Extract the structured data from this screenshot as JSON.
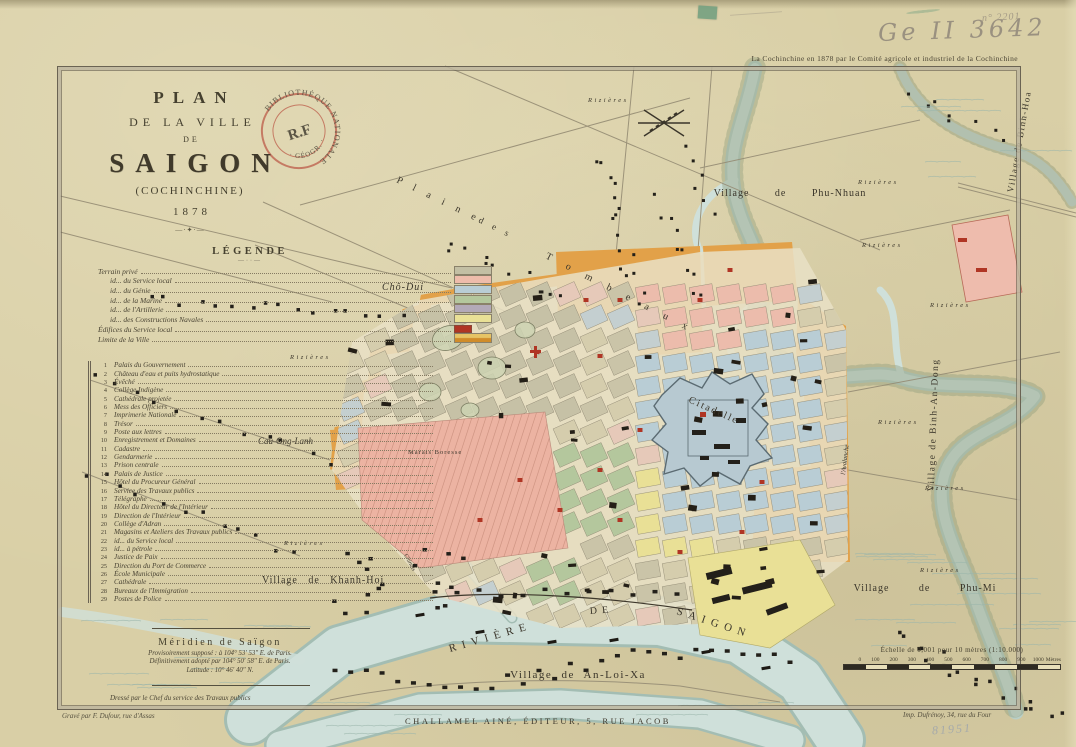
{
  "header": {
    "pencil_number": "n° 2201",
    "shelfmark": "Ge II 3642",
    "credit": "La Cochinchine en 1878 par le Comité agricole et industriel de la Cochinchine"
  },
  "title_block": {
    "plan": "PLAN",
    "de_la_ville": "DE LA VILLE",
    "de": "DE",
    "city": "SAIGON",
    "region": "(COCHINCHINE)",
    "year": "1878",
    "ornament": "—·✦·—"
  },
  "stamp": {
    "arc_top": "BIBLIOTHÈQUE NATIONALE",
    "center": "R.F",
    "arc_bottom": "· GÉOGR. ·"
  },
  "legend": {
    "title": "LÉGENDE",
    "ornament": "—··—",
    "items": [
      {
        "label": "Terrain privé",
        "color": "#c3bfa4"
      },
      {
        "label": "id... du Service local",
        "color": "#eebcab"
      },
      {
        "label": "id... du Génie",
        "color": "#b9cdd5"
      },
      {
        "label": "id... de la Marine",
        "color": "#b4c79d"
      },
      {
        "label": "id... de l'Artillerie",
        "color": "#b3a9b8"
      },
      {
        "label": "id... des Constructions Navales",
        "color": "#e9e096"
      },
      {
        "label": "Édifices du Service local",
        "color": "#b03524",
        "small": true
      },
      {
        "label": "Limite de la Ville",
        "color": "#e2a149",
        "band": true
      }
    ]
  },
  "index": {
    "items": [
      {
        "n": "1",
        "label": "Palais du Gouvernement"
      },
      {
        "n": "2",
        "label": "Château d'eau et puits hydrostatique"
      },
      {
        "n": "3",
        "label": "Évêché"
      },
      {
        "n": "4",
        "label": "Collège Indigène"
      },
      {
        "n": "5",
        "label": "Cathédrale projetée"
      },
      {
        "n": "6",
        "label": "Mess des Officiers"
      },
      {
        "n": "7",
        "label": "Imprimerie Nationale"
      },
      {
        "n": "8",
        "label": "Trésor"
      },
      {
        "n": "9",
        "label": "Poste aux lettres"
      },
      {
        "n": "10",
        "label": "Enregistrement et Domaines"
      },
      {
        "n": "11",
        "label": "Cadastre"
      },
      {
        "n": "12",
        "label": "Gendarmerie"
      },
      {
        "n": "13",
        "label": "Prison centrale"
      },
      {
        "n": "14",
        "label": "Palais de Justice"
      },
      {
        "n": "15",
        "label": "Hôtel du Procureur Général"
      },
      {
        "n": "16",
        "label": "Service des Travaux publics"
      },
      {
        "n": "17",
        "label": "Télégraphe"
      },
      {
        "n": "18",
        "label": "Hôtel du Directeur de l'Intérieur"
      },
      {
        "n": "19",
        "label": "Direction de l'Intérieur"
      },
      {
        "n": "20",
        "label": "Collège d'Adran"
      },
      {
        "n": "21",
        "label": "Magasins et Ateliers des Travaux publics"
      },
      {
        "n": "22",
        "label": "id... du Service local"
      },
      {
        "n": "23",
        "label": "id... à pétrole"
      },
      {
        "n": "24",
        "label": "Justice de Paix"
      },
      {
        "n": "25",
        "label": "Direction du Port de Commerce"
      },
      {
        "n": "26",
        "label": "École Municipale"
      },
      {
        "n": "27",
        "label": "Cathédrale"
      },
      {
        "n": "28",
        "label": "Bureaux de l'Immigration"
      },
      {
        "n": "29",
        "label": "Postes de Police"
      }
    ]
  },
  "meridian": {
    "title": "Méridien de Saïgon",
    "line1": "Provisoirement supposé : à 104° 53′ 53″ E. de Paris.",
    "line2": "Définitivement adopté par 104° 50′ 58″ E. de Paris.",
    "line3": "Latitude : 10° 46′ 40″ N."
  },
  "notes": {
    "drawn_by": "Dressé par le Chef du service des Travaux publics"
  },
  "imprint": {
    "engraver": "Gravé par F. Dufour, rue d'Assas",
    "publisher": "CHALLAMEL AINÉ, ÉDITEUR, 5, RUE JACOB",
    "printer": "Imp. Dufrénoy, 34, rue du Four",
    "inventory": "81951"
  },
  "scale": {
    "label": "Échelle de 0,001 pour 10 mètres (1:10.000)",
    "ticks": [
      "0",
      "100",
      "200",
      "300",
      "400",
      "500",
      "600",
      "700",
      "800",
      "900",
      "1000"
    ],
    "unit": "Mètres"
  },
  "map_labels": {
    "plaine": "P l a i n e",
    "des": "d e s",
    "tombeaux": "T o m b e a u x",
    "cho_dui": "Chô-Dui",
    "cau_ong_lanh": "Cau-Ong-Lanh",
    "marais_boresse": "Marais  Boresse",
    "citadelle": "Citadelle",
    "chinois": "Chinois",
    "avalanche": "l'Avalanche",
    "phu_nhuan": "Village de Phu-Nhuan",
    "binh_hoa": "Village de Binh-Hoa",
    "binh_an_dong": "Village de Binh-An-Dong",
    "khanh_hoi": "Village de Khanh-Hoi",
    "phu_mi": "Village de Phu-Mi",
    "an_loi_xa": "Village de An-Loi-Xa",
    "riviere": "RIVIÈRE",
    "de_word": "DE",
    "saigon": "SAIGON",
    "rizieres": "Rizières"
  }
}
